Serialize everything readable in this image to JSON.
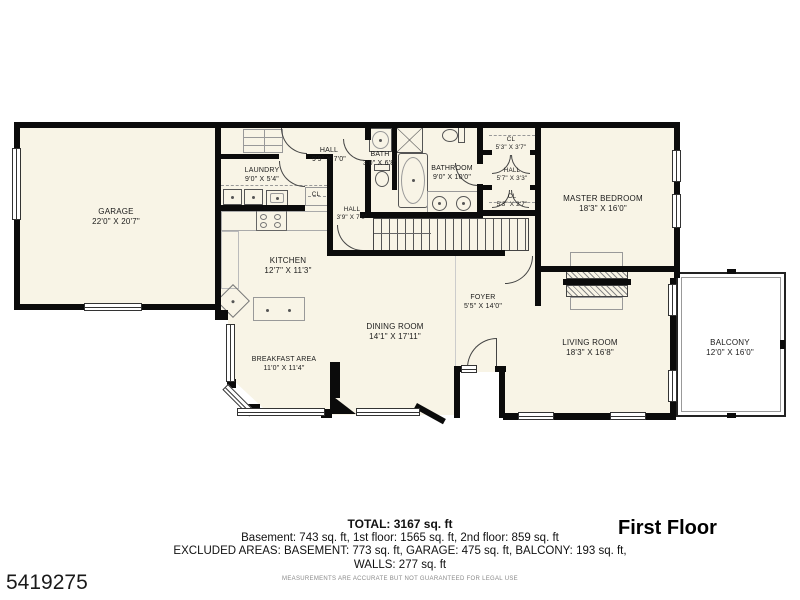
{
  "branding": {
    "listing_id": "5419275",
    "floor_title": "First Floor"
  },
  "summary": {
    "total": "TOTAL: 3167 sq. ft",
    "breakdown": "Basement: 743 sq. ft, 1st floor: 1565 sq. ft, 2nd floor: 859 sq. ft",
    "excluded": "EXCLUDED AREAS: BASEMENT: 773 sq. ft, GARAGE: 475 sq. ft, BALCONY: 193 sq. ft,",
    "walls": "WALLS: 277 sq. ft",
    "disclaimer": "MEASUREMENTS ARE ACCURATE BUT NOT GUARANTEED FOR LEGAL USE"
  },
  "rooms": {
    "garage": {
      "name": "GARAGE",
      "dims": "22'0\" X 20'7\""
    },
    "laundry": {
      "name": "LAUNDRY",
      "dims": "9'0\" X 5'4\""
    },
    "hall_upper": {
      "name": "HALL",
      "dims": "9'9\" X 7'0\""
    },
    "bath": {
      "name": "BATH",
      "dims": "3'0\" X 6'8\""
    },
    "bathroom": {
      "name": "BATHROOM",
      "dims": "9'0\" X 10'0\""
    },
    "closet_top": {
      "name": "CL",
      "dims": "5'3\" X 3'7\""
    },
    "hall_master": {
      "name": "HALL",
      "dims": "5'7\" X 3'3\""
    },
    "closet_bottom": {
      "name": "CL",
      "dims": "5'3\" X 2'7\""
    },
    "master_bedroom": {
      "name": "MASTER BEDROOM",
      "dims": "18'3\" X 16'0\""
    },
    "hall_lower": {
      "name": "HALL",
      "dims": "3'9\" X 7'0\""
    },
    "kitchen": {
      "name": "KITCHEN",
      "dims": "12'7\" X 11'3\""
    },
    "laundry_closet": {
      "name": "CL"
    },
    "foyer": {
      "name": "FOYER",
      "dims": "5'5\" X 14'0\""
    },
    "dining_room": {
      "name": "DINING ROOM",
      "dims": "14'1\" X 17'11\""
    },
    "breakfast_area": {
      "name": "BREAKFAST AREA",
      "dims": "11'0\" X 11'4\""
    },
    "living_room": {
      "name": "LIVING ROOM",
      "dims": "18'3\" X 16'8\""
    },
    "balcony": {
      "name": "BALCONY",
      "dims": "12'0\" X 16'0\""
    }
  },
  "colors": {
    "floor_fill": "#F8F4E6",
    "wall": "#0B0B0B",
    "balcony_fill": "#FFFFFF",
    "text": "#1A1A1A"
  }
}
